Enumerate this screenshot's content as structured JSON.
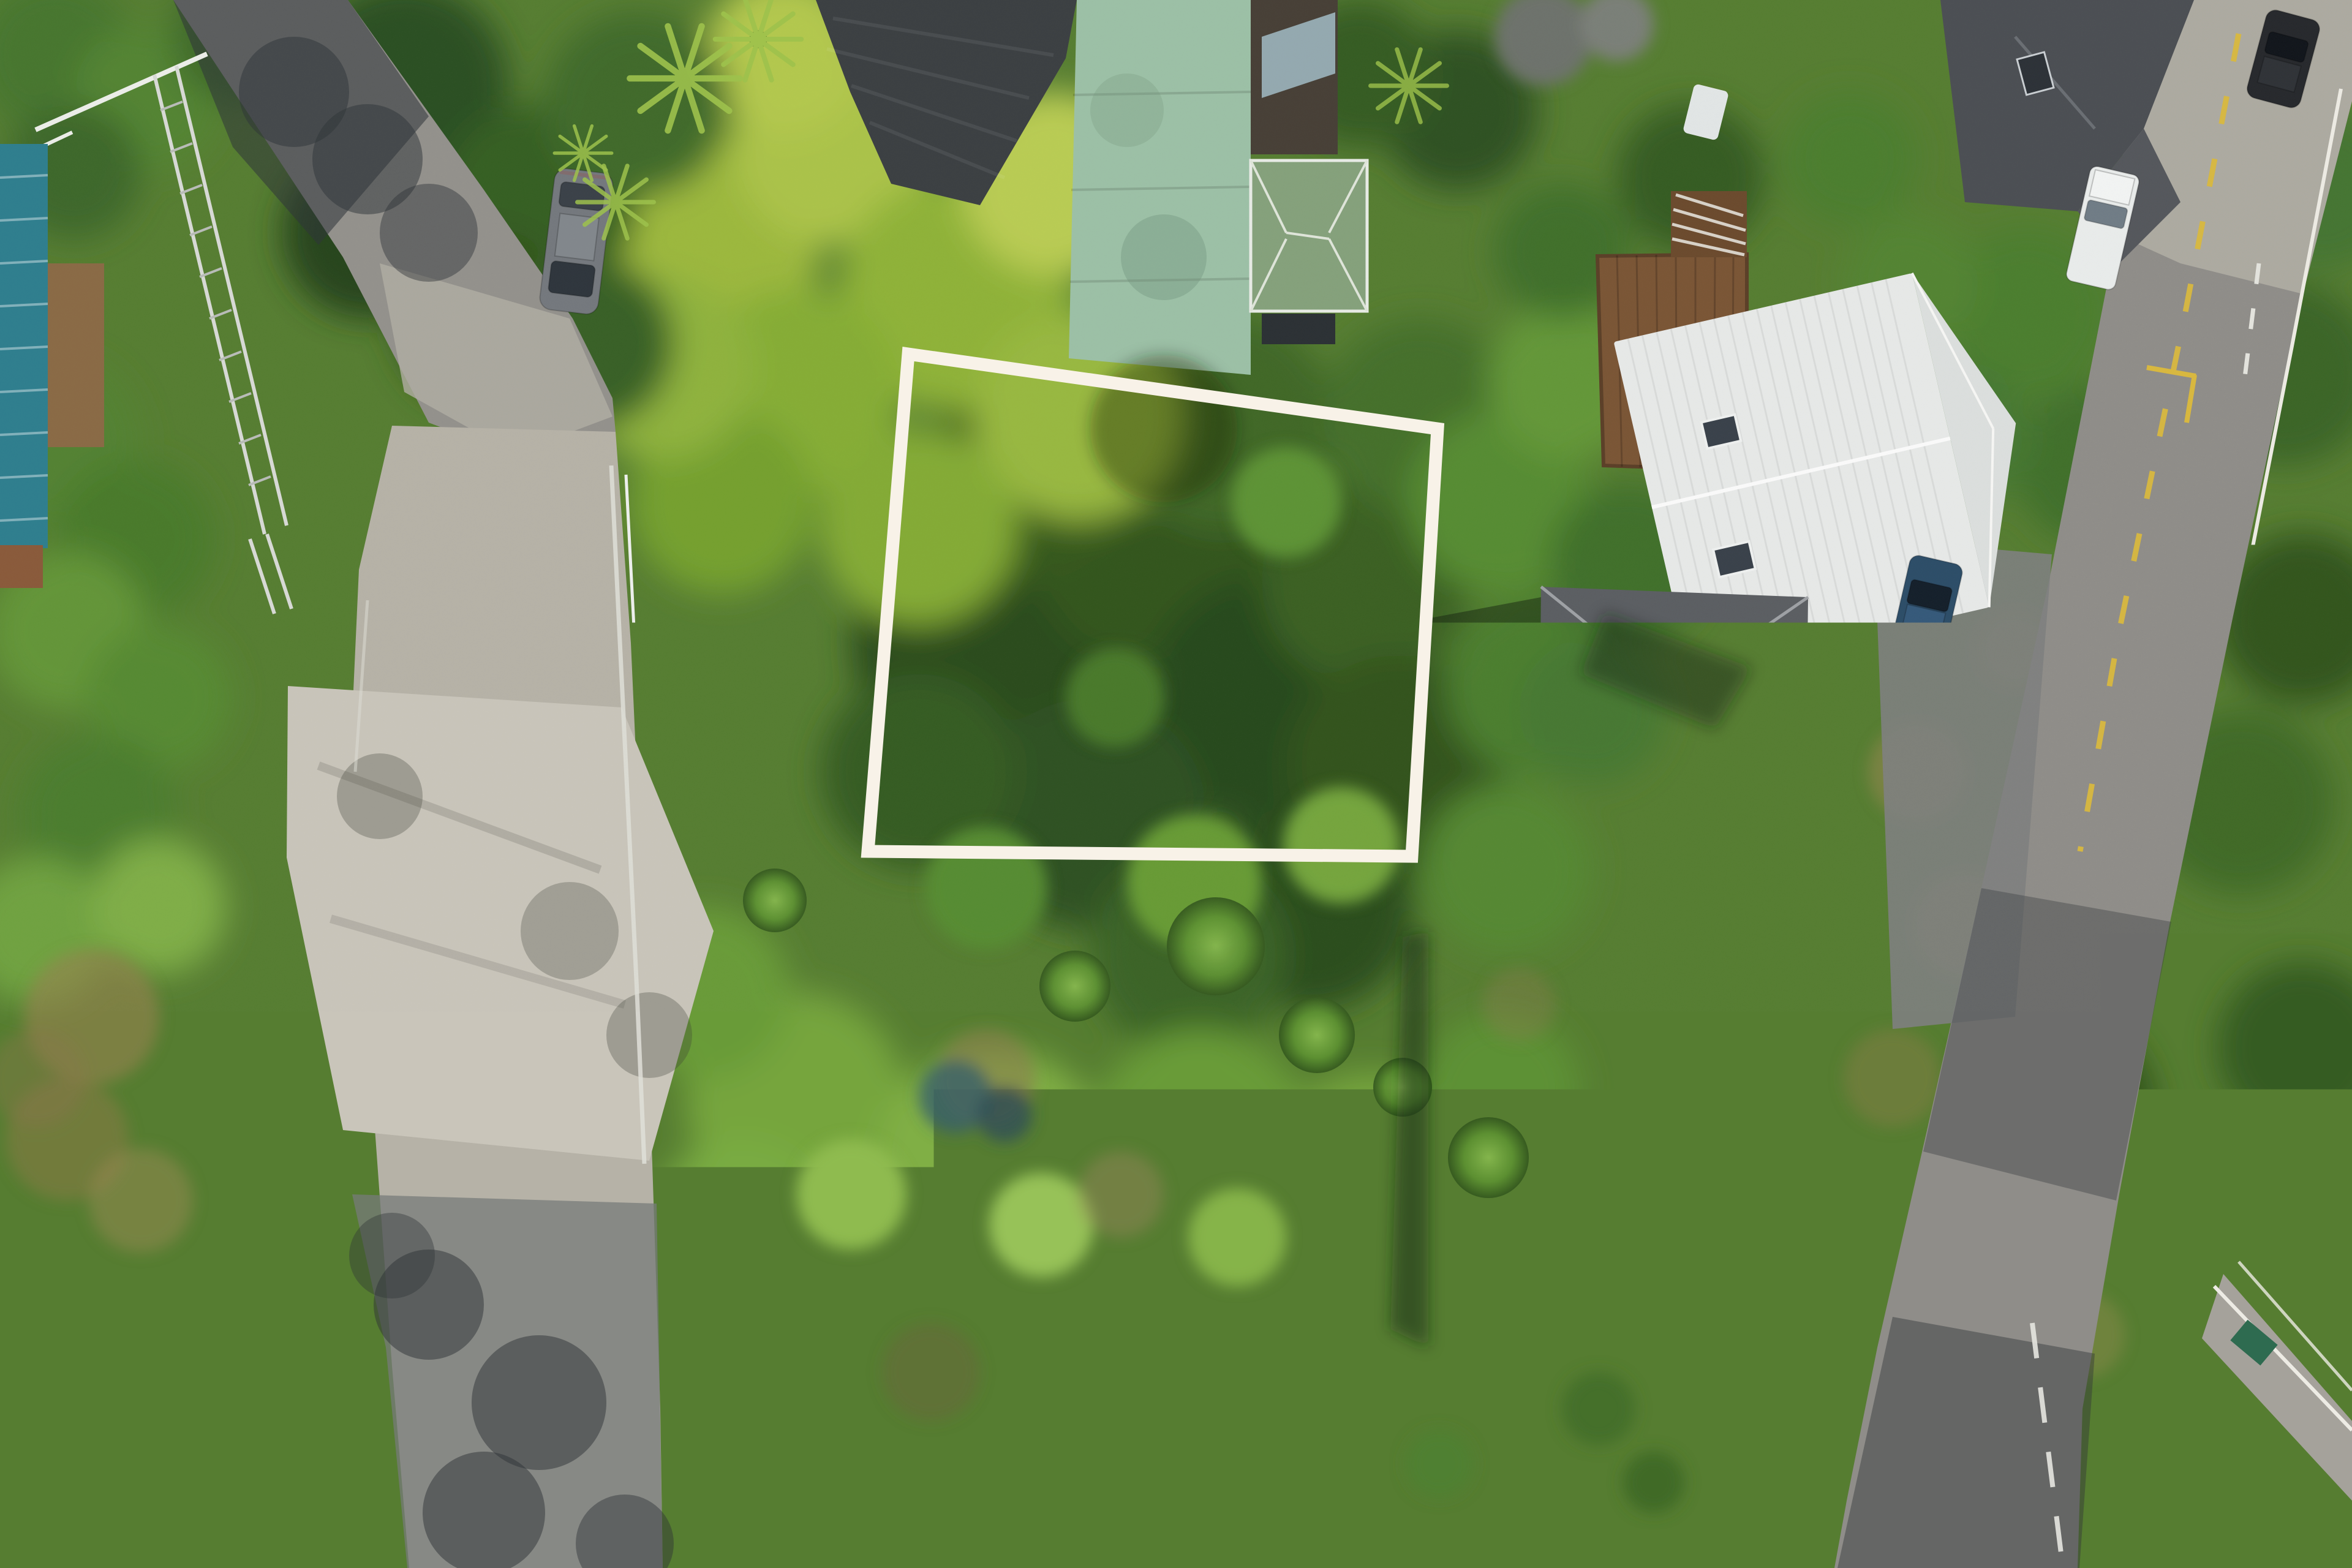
{
  "overlay": {
    "label": "Indicative Boundary Line",
    "label_color": "#ffffff",
    "boundary_color": "#f8f2e8",
    "boundary_stroke_width": 21,
    "boundary_points": "1483,578 2347,700 2305,1398 1417,1390"
  },
  "palette": {
    "canopy_dark": "#2a4b1e",
    "canopy_mid": "#4f8030",
    "canopy_bright": "#a9c14a",
    "lawn_green": "#80af45",
    "road_asphalt": "#8f8d89",
    "road_shadow": "#383c3e",
    "concrete_driveway": "#c9c5ba",
    "roof_charcoal": "#3b3f42",
    "roof_verdigris": "#9cc0a6",
    "roof_olive_green": "#85a17b",
    "roof_white": "#e7e9e8",
    "roof_dark_gray": "#5b5e62",
    "roof_blue_gray": "#a4b9c8",
    "roof_brown": "#6d5446",
    "roof_yellow": "#f1b31f",
    "roof_teal": "#2e7e8e",
    "wall_terracotta": "#b4715a",
    "deck_timber": "#7a5535",
    "car_blue": "#1f70b6",
    "car_teal": "#1e8f96",
    "marking_yellow": "#d9b83e",
    "railing_white": "#edebe4"
  }
}
